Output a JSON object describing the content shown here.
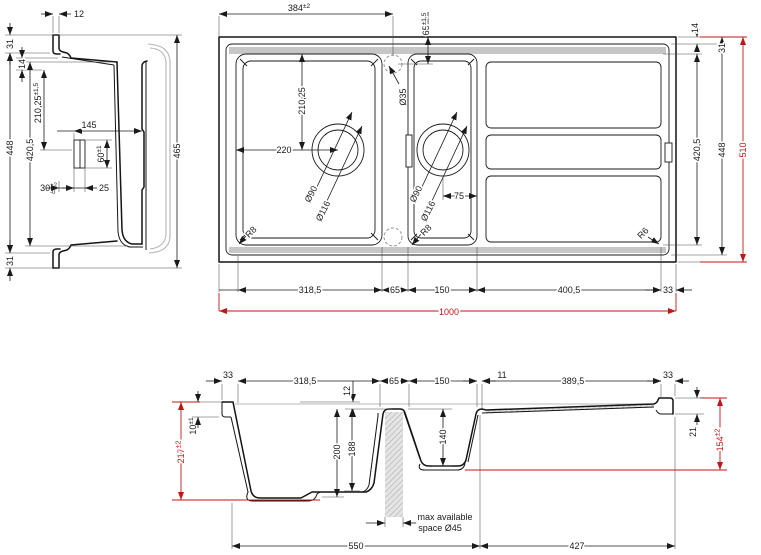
{
  "colors": {
    "line": "#1a1a1a",
    "dimension_red": "#c11616",
    "ghost_gray": "#b5b5b5"
  },
  "side_view": {
    "dims": {
      "lip_width": "12",
      "top_flange_height": "31",
      "deck_step": "14",
      "bowl_center_from_top": {
        "v": "210,25",
        "tol": "±1,5"
      },
      "flange_to_flange_height": "448",
      "overall_inner_height": "420,5",
      "overflow_to_wall": "145",
      "overflow_height": {
        "v": "60",
        "tol": "±1"
      },
      "overflow_width": "25",
      "overflow_offset": {
        "v": "30",
        "sup": "+2",
        "sub": "-0"
      },
      "overall_height": "465",
      "bottom_flange_height": "31"
    }
  },
  "plan_view": {
    "dims": {
      "tap_center_from_left": {
        "v": "384",
        "tol": "±2"
      },
      "tap_center_from_edge": {
        "v": "65",
        "tol": "±1,5"
      },
      "tap_hole_diameter": "Ø35",
      "rim_width": "14",
      "deck_width": "31",
      "bowls_length": "420,5",
      "inner_length": "448",
      "overall_width": "510",
      "main_drain_from_top": "210,25",
      "main_drain_from_left": "220",
      "main_drain_inner": "Ø90",
      "main_drain_outer": "Ø116",
      "small_drain_inner": "Ø90",
      "small_drain_outer": "Ø116",
      "small_drain_from_right": "75",
      "main_bowl_corner": "R8",
      "small_bowl_corner": "R8",
      "drainboard_corner": "R6",
      "main_bowl_width": "318,5",
      "divider_width": "65",
      "small_bowl_width": "150",
      "drainboard_width": "400,5",
      "edge_margin": "33",
      "overall_length": "1000"
    }
  },
  "section_view": {
    "dims": {
      "left_margin": "33",
      "main_bowl_width": "318,5",
      "rim_step": "12",
      "divider_width": "65",
      "small_bowl_width": "150",
      "bowl_to_drainboard": "11",
      "drainboard_width": "389,5",
      "right_margin": "33",
      "lip_height": {
        "v": "10",
        "tol": "±1"
      },
      "overall_depth": {
        "v": "217",
        "tol": "±2"
      },
      "main_bowl_depth_center": "200",
      "main_bowl_depth_edge": "188",
      "small_bowl_depth": "140",
      "drainboard_edge_height": "21",
      "drainboard_end_depth": {
        "v": "154",
        "tol": "±2"
      },
      "bowls_span": "550",
      "drainboard_span": "427"
    },
    "note": {
      "line1": "max available",
      "line2": "space Ø45"
    }
  }
}
